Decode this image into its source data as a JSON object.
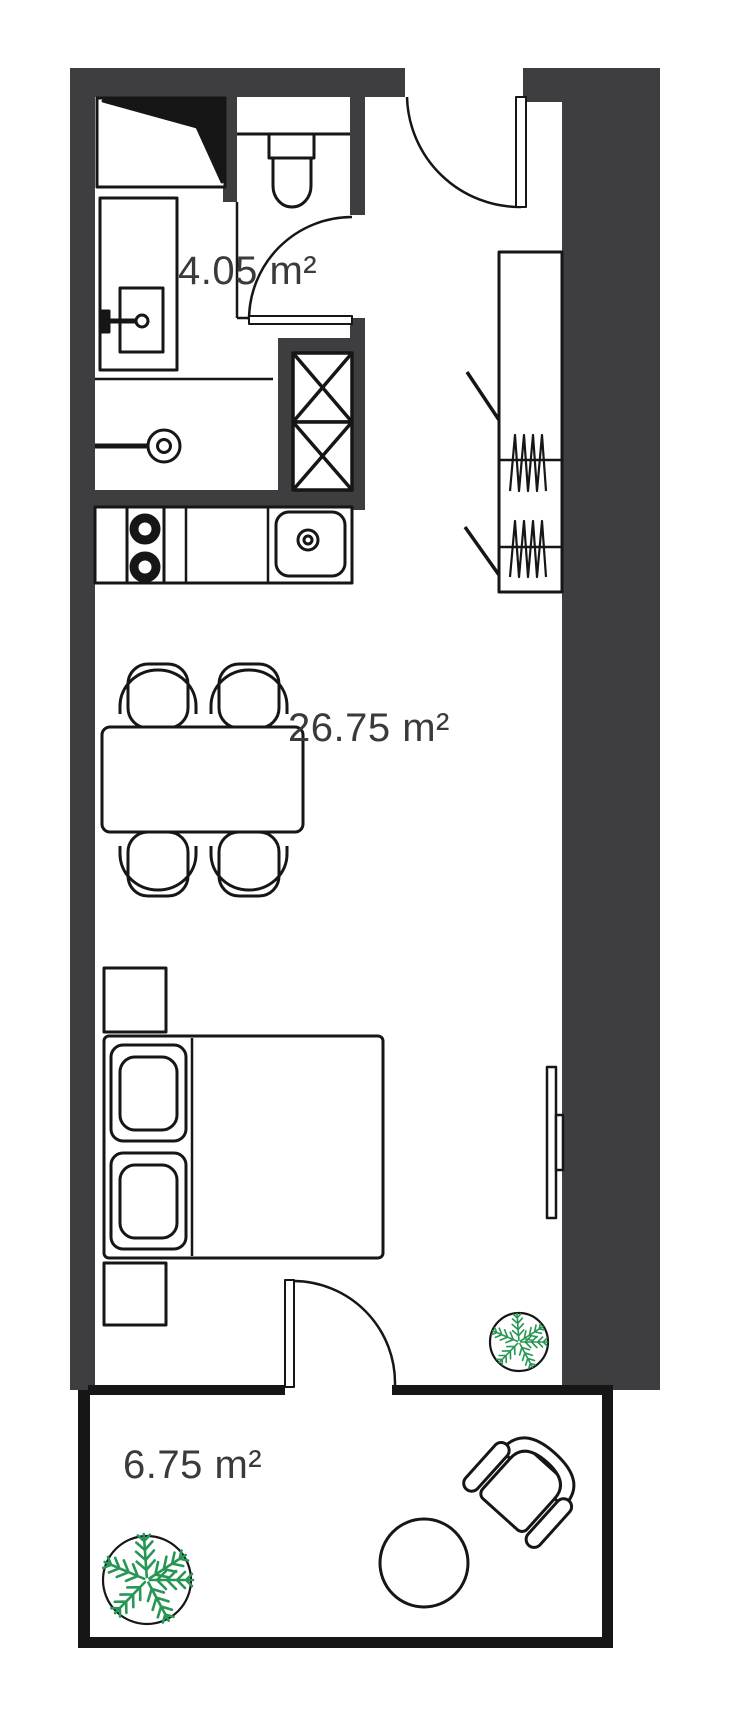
{
  "plan": {
    "title": "apartment-floor-plan",
    "rooms": {
      "bathroom": {
        "area_label": "4.05 m²"
      },
      "living": {
        "area_label": "26.75 m²"
      },
      "balcony": {
        "area_label": "6.75 m²"
      }
    },
    "colors": {
      "wall": "#3e3e40",
      "wall_thin": "#161616",
      "line": "#161616",
      "floor": "#ffffff",
      "text": "#3a3a3a",
      "plant": "#289655"
    },
    "icons": [
      "shower-icon",
      "toilet-icon",
      "vanity-sink-icon",
      "faucet-icon",
      "floor-drain-icon",
      "ventilation-shaft-icon",
      "stove-icon",
      "kitchen-sink-icon",
      "wardrobe-icon",
      "hanging-clothes-icon",
      "dining-table-icon",
      "dining-chair-icon",
      "double-bed-icon",
      "pillow-icon",
      "nightstand-icon",
      "radiator-icon",
      "potted-plant-icon",
      "armchair-icon",
      "coffee-table-icon",
      "door-swing-icon"
    ]
  }
}
